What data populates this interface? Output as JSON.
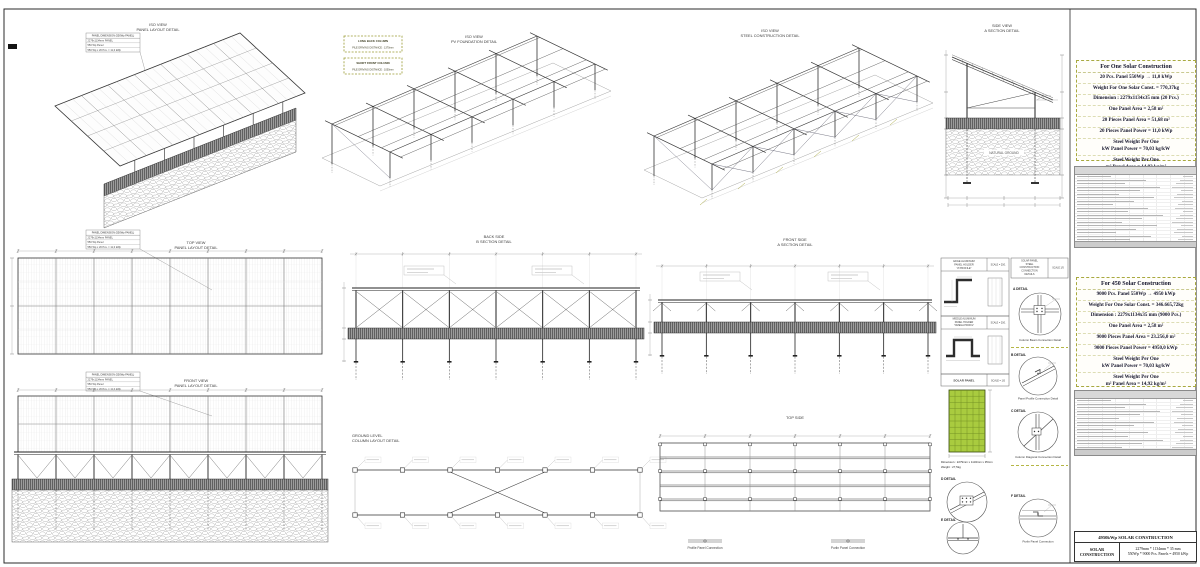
{
  "views": {
    "iso_panel": {
      "l1": "ISO VIEW",
      "l2": "PANEL LAYOUT DETAIL"
    },
    "iso_foundation": {
      "l1": "ISO VIEW",
      "l2": "PV FOUNDATION DETAIL",
      "legend1_l1": "LONG BACK COLUMN",
      "legend1_l2": "PILE DRIVING DISTANCE : 1370mm",
      "legend2_l1": "SHORT FRONT COLUMN",
      "legend2_l2": "PILE DRIVING DISTANCE : 1050mm"
    },
    "iso_steel": {
      "l1": "ISO VIEW",
      "l2": "STEEL CONSTRUCTION DETAIL"
    },
    "side_section": {
      "l1": "SIDE VIEW",
      "l2": "A SECTION DETAIL",
      "ground_label": "NATURAL GROUND"
    },
    "top_view": {
      "l1": "TOP VIEW",
      "l2": "PANEL LAYOUT DETAIL"
    },
    "back_side": {
      "l1": "BACK SIDE",
      "l2": "B SECTION DETAIL"
    },
    "front_side": {
      "l1": "FRONT SIDE",
      "l2": "A SECTION DETAIL"
    },
    "front_view": {
      "l1": "FRONT VIEW",
      "l2": "PANEL LAYOUT DETAIL"
    },
    "ground_level": {
      "l1": "GROUND LEVEL",
      "l2": "COLUMN LAYOUT DETAIL"
    },
    "top_side": {
      "l1": "TOP SIDE",
      "l2": ""
    }
  },
  "panel_note": {
    "header": "PANEL DIMENSION (550Wp PANEL)",
    "lines": [
      "2279x1134mm PANEL",
      "550 Wp Panel",
      "550 Wp x 20 Pcs. = 11,0 kWp"
    ]
  },
  "details": {
    "z_profile_label": "EDGE ALUMINUM PANEL HOLDER \"Z PROFILE\"",
    "z_profile_scale": "SCALE = 20/1",
    "omega_label": "MIDDLE ALUMINUM PANEL HOLDER \"OMEGA PROFIL\"",
    "omega_scale": "SCALE = 20/1",
    "solar_panel_label": "SOLAR PANEL",
    "solar_panel_scale": "SCALE = 1/5",
    "solar_panel_dim": "Dimension : 2279mm x 1134mm x 35mm",
    "solar_panel_weight": "Weight : 27,5kg",
    "conn_header": "SOLAR PANEL STEEL CONSTRUCTION CONNECTION DETAILS",
    "conn_scale": "SCALE 1/5",
    "a_label": "A DETAIL",
    "a_caption": "Column Beam Connection Detail",
    "b_label": "B DETAIL",
    "b_caption": "Panel Profile Connection Detail",
    "c_label": "C DETAIL",
    "c_caption": "Column Diagonal Connection Detail",
    "d_label": "D DETAIL",
    "e_label": "E DETAIL",
    "f_label": "F DETAIL",
    "f_caption": "Purlin Panel Connection",
    "cap_profile": "Profile Panel Connection",
    "cap_purlin": "Purlin Panel Connection"
  },
  "spec_one": {
    "title": "For One Solar Construction",
    "lines": [
      "20 Pcs. Panel 550Wp  →  11,0 kWp",
      "Weight For One Solar Const. = 770,37kg",
      "Dimension : 2279x1134x35 mm (20 Pcs.)",
      "One Panel Area =  2,58 m²",
      "20 Pieces Panel Area =  51,68 m²",
      "20 Pieces Panel Power =  11,0 kWp",
      "Steel Weight Per One\nkW Panel Power = 70,03 kg/kW",
      "Steel Weight Per One\nm² Panel Area = 14,92 kg/m²"
    ]
  },
  "spec_all": {
    "title": "For 450 Solar Construction",
    "lines": [
      "9000 Pcs. Panel 550Wp → 4950 kWp",
      "Weight For One Solar Const. = 346.665,72kg",
      "Dimension : 2279x1134x35 mm (9000 Pcs.)",
      "One Panel Area =  2,58 m²",
      "9000 Pieces Panel Area = 23.256,0 m²",
      "9000 Pieces Panel Power =  4950,0 kWp",
      "Steel Weight Per One\nkW Panel Power = 70,03 kg/kW",
      "Steel Weight Per One\nm² Panel Area = 14,92 kg/m²"
    ]
  },
  "title_block": {
    "project": "4950kWp SOLAR CONSTRUCTION",
    "left": "SOLAR CONSTRUCTION",
    "right_line1": "2279mm * 1134mm * 35 mm",
    "right_line2": "550Wp * 9000 Pcs. Panels = 4950 kWp"
  }
}
